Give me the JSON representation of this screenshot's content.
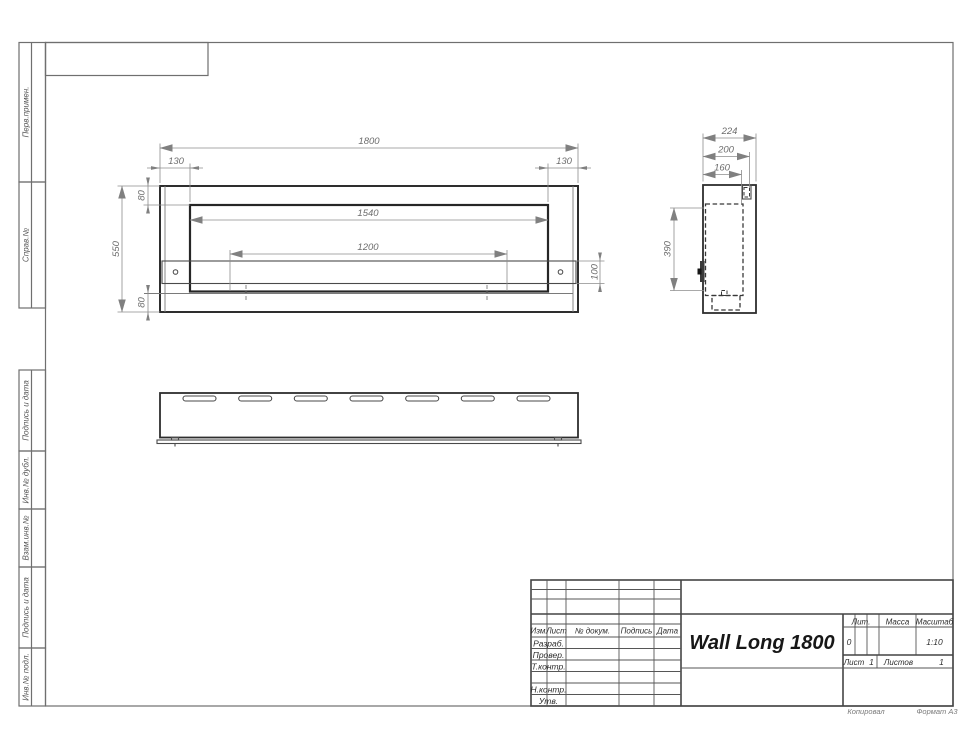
{
  "sheet": {
    "footer": {
      "copied": "Копировал",
      "format": "Формат А3"
    },
    "margin_labels": [
      "Перв.примен.",
      "Справ.№",
      "Подпись и дата",
      "Инв.№ дубл.",
      "Взам.инв.№",
      "Подпись и дата",
      "Инв.№ подл."
    ]
  },
  "views": {
    "front": {
      "dims": {
        "overall_width": "1800",
        "offset_left": "130",
        "offset_right": "130",
        "top_inset": "80",
        "overall_height": "550",
        "opening_width": "1540",
        "inner_span": "1200",
        "band_height": "100",
        "bottom_inset": "80"
      }
    },
    "side": {
      "dims": {
        "overall_depth": "224",
        "inner_depth": "200",
        "mount_depth": "160",
        "opening_height": "390"
      }
    }
  },
  "title_block": {
    "product_name": "Wall Long 1800",
    "columns": {
      "izm": "Изм.",
      "list": "Лист",
      "doc_num": "№ докум.",
      "sign": "Подпись",
      "date": "Дата"
    },
    "rows": {
      "developed": "Разраб.",
      "checked": "Провер.",
      "tcontrol": "Т.контр.",
      "ncontrol": "Н.контр.",
      "approved": "Утв."
    },
    "lit": {
      "label": "Лит.",
      "value": "0"
    },
    "mass": {
      "label": "Масса",
      "value": ""
    },
    "scale": {
      "label": "Масштаб",
      "value": "1:10"
    },
    "sheet_no": {
      "label": "Лист",
      "value": "1"
    },
    "sheets_total": {
      "label": "Листов",
      "value": "1"
    }
  }
}
